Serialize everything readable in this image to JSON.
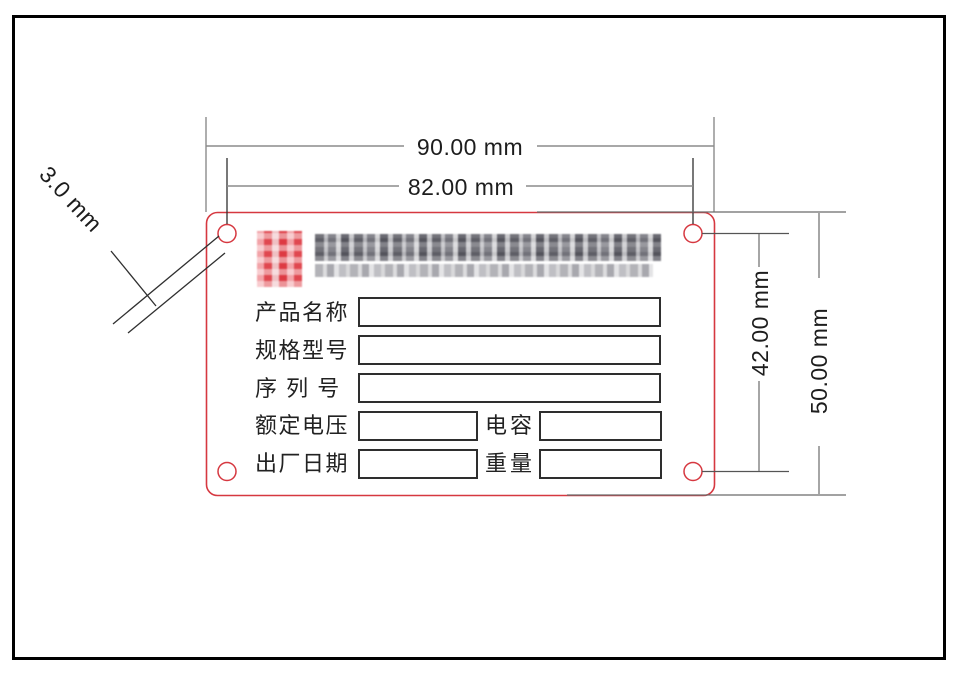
{
  "dimensions": {
    "overall_width": "90.00 mm",
    "hole_spacing_horizontal": "82.00 mm",
    "hole_diameter": "3.0 mm",
    "hole_spacing_vertical": "42.00 mm",
    "overall_height": "50.00 mm"
  },
  "plate": {
    "outline_color": "#d63840",
    "logo_color": "#e23b43",
    "rows": {
      "row1_label": "产品名称",
      "row2_label": "规格型号",
      "row3_label": "序 列 号",
      "row4_label": "额定电压",
      "row4_label2": "电容",
      "row5_label": "出厂日期",
      "row5_label2": "重量"
    }
  }
}
